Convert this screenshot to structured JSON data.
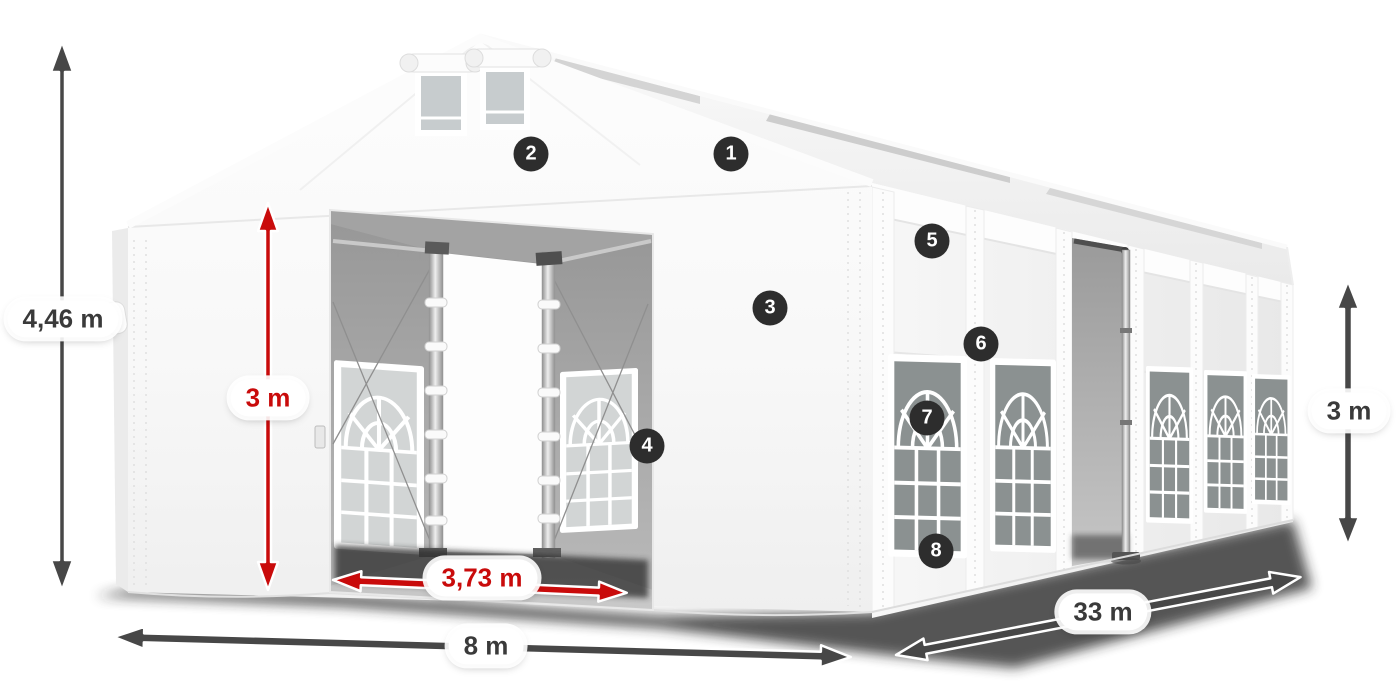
{
  "diagram": {
    "subject": "party-tent-dimension-diagram",
    "dimension_labels": {
      "total_height": "4,46 m",
      "entrance_height": "3 m",
      "entrance_width": "3,73 m",
      "front_width": "8 m",
      "side_length": "33 m",
      "side_wall_height": "3 m"
    },
    "callout_numbers": [
      "1",
      "2",
      "3",
      "4",
      "5",
      "6",
      "7",
      "8"
    ],
    "colors": {
      "dimension_red": "#c90b0b",
      "dimension_dark": "#474747",
      "badge_background": "#2d2d2d",
      "badge_text": "#ffffff",
      "label_background": "#ffffff",
      "label_text_dark": "#3a3a3a",
      "tent_white": "#ffffff",
      "ground_shadow": "#262626"
    }
  }
}
